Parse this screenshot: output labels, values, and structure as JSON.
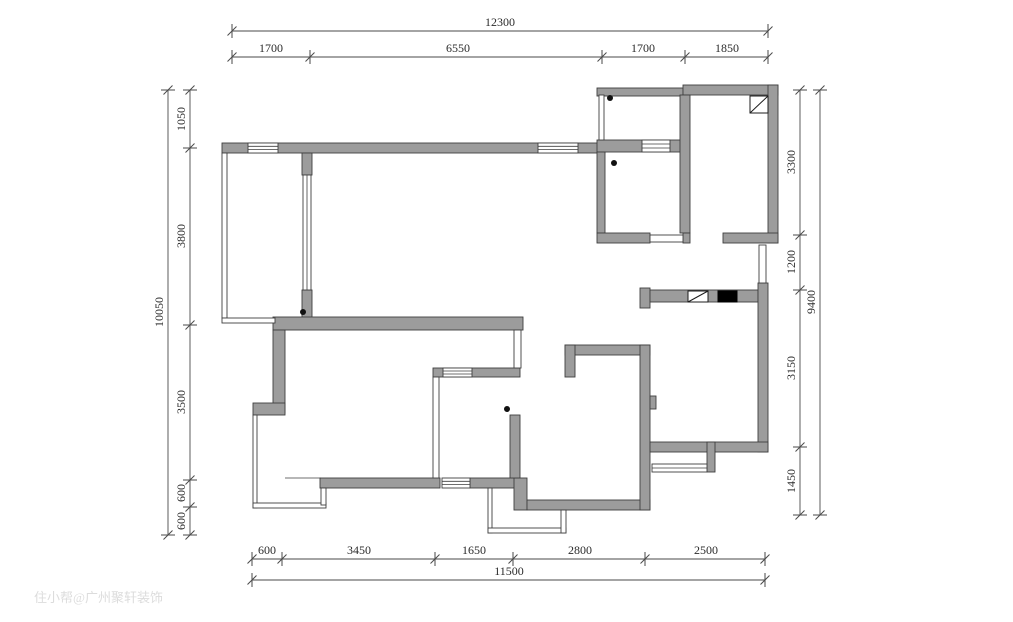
{
  "drawing": {
    "type": "residential-floor-plan",
    "units": "mm",
    "watermark": "住小帮@广州聚轩装饰"
  },
  "dims": {
    "top": {
      "total": "12300",
      "segments": [
        "1700",
        "6550",
        "1700",
        "1850"
      ]
    },
    "bottom": {
      "total": "11500",
      "segments": [
        "600",
        "3450",
        "1650",
        "2800",
        "2500"
      ]
    },
    "left": {
      "total": "10050",
      "segments": [
        "1050",
        "3800",
        "3500",
        "600",
        "600"
      ]
    },
    "right": {
      "total": "9400",
      "segments": [
        "3300",
        "1200",
        "3150",
        "1450"
      ]
    }
  },
  "colors": {
    "background": "#ffffff",
    "wall_fill": "#9c9c9c",
    "wall_stroke": "#3f3f3f",
    "dimension_line": "#4a4a4a",
    "text": "#2b2b2b",
    "duct_fill": "#000000",
    "watermark_text": "#d9d9d9"
  },
  "symbols": {
    "door_pivot": "black-dot",
    "flue_shaft": "rect-with-diagonal",
    "duct_riser": "solid-black-rect",
    "window": "parallel-lines"
  }
}
